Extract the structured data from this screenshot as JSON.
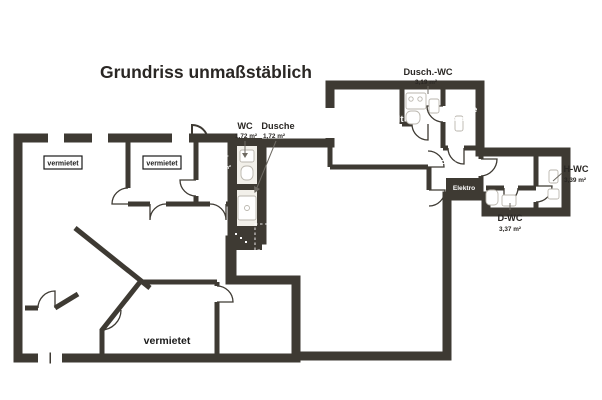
{
  "title": "Grundriss unmaßstäblich",
  "colors": {
    "wall": "#3e3a33",
    "rented_fill_dark": "#b9491f",
    "rented_fill_light": "#d2613a",
    "vacant_fill_dark": "#35511f",
    "vacant_fill_light": "#5e7c44"
  },
  "badges": {
    "vermietet": "vermietet"
  },
  "rooms": {
    "raum_46_90": {
      "name": "Raum",
      "area": "46,90 m²"
    },
    "buero_17_63": {
      "name": "Büro",
      "area": "17,63 m²"
    },
    "flur_5_80": {
      "name": "Flur",
      "area": "5,80 m²"
    },
    "flur_38_74": {
      "name": "Flur",
      "area": "38,74 m²"
    },
    "raum_24_92": {
      "name": "Raum",
      "area": "24,92 m²"
    },
    "buero_18_18": {
      "name": "Büro",
      "area": "18,18 m²"
    },
    "wc": {
      "name": "WC",
      "area": "1,72 m²"
    },
    "dusche": {
      "name": "Dusche",
      "area": "1,72 m²"
    },
    "raum_118_83": {
      "name": "Raum",
      "area": "118,83 m²"
    },
    "aufenthalt": {
      "name": "Aufenthalt",
      "area": "13,48 m²"
    },
    "dusch_wc": {
      "name": "Dusch.-WC",
      "area": "3,19 m²"
    },
    "kueche": {
      "name": "Küche",
      "area": "9,08 m²"
    },
    "flur_5_05": {
      "name": "Flur",
      "area": "5,05 m²"
    },
    "vorraum": {
      "name": "Vorraum",
      "area": "2,52 m²"
    },
    "elektro": {
      "name": "Elektro"
    },
    "h_wc": {
      "name": "H-WC",
      "area": "3,39 m²"
    },
    "d_wc": {
      "name": "D-WC",
      "area": "3,37 m²"
    }
  }
}
